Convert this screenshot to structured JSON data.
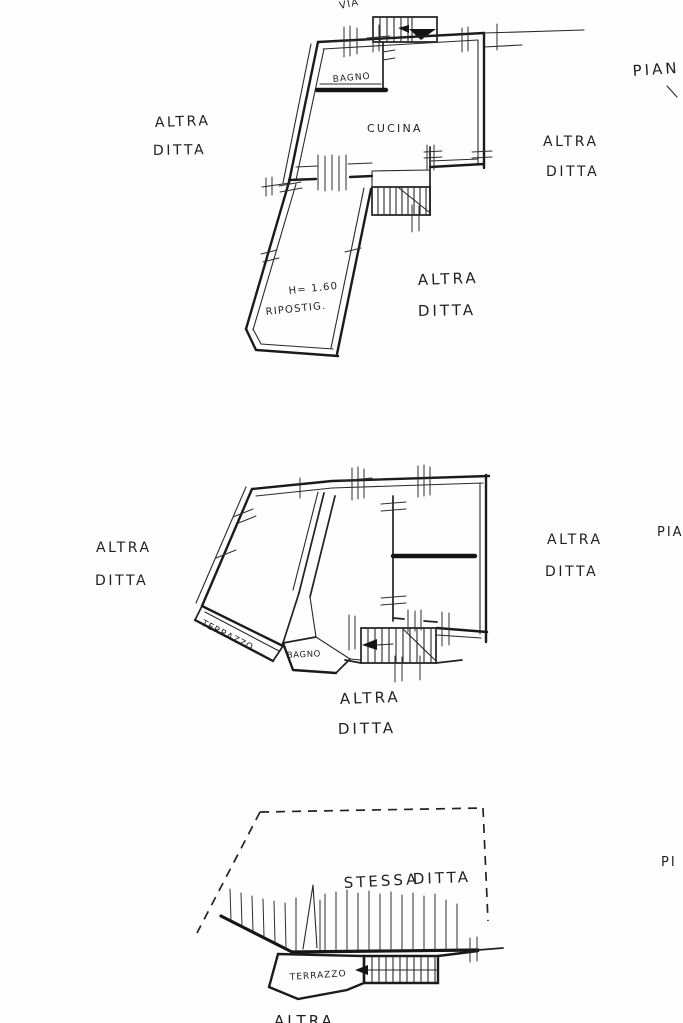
{
  "colors": {
    "ink": "#1b1b1b",
    "paper": "#fefefe"
  },
  "labels": {
    "shared": {
      "altra": "ALTRA",
      "ditta": "DITTA"
    },
    "plan1": {
      "via": "VIA",
      "pian": "PIAN",
      "bagno": "BAGNO",
      "cucina": "CUCINA",
      "height_note": "H= 1.60",
      "ripostiglio": "RIPOSTIG."
    },
    "plan2": {
      "terrazzo": "TERRAZZO",
      "bagno": "BAGNO",
      "pia": "PIA"
    },
    "plan3": {
      "stessa": "STESSA",
      "terrazzo": "TERRAZZO",
      "pi": "PI"
    }
  }
}
